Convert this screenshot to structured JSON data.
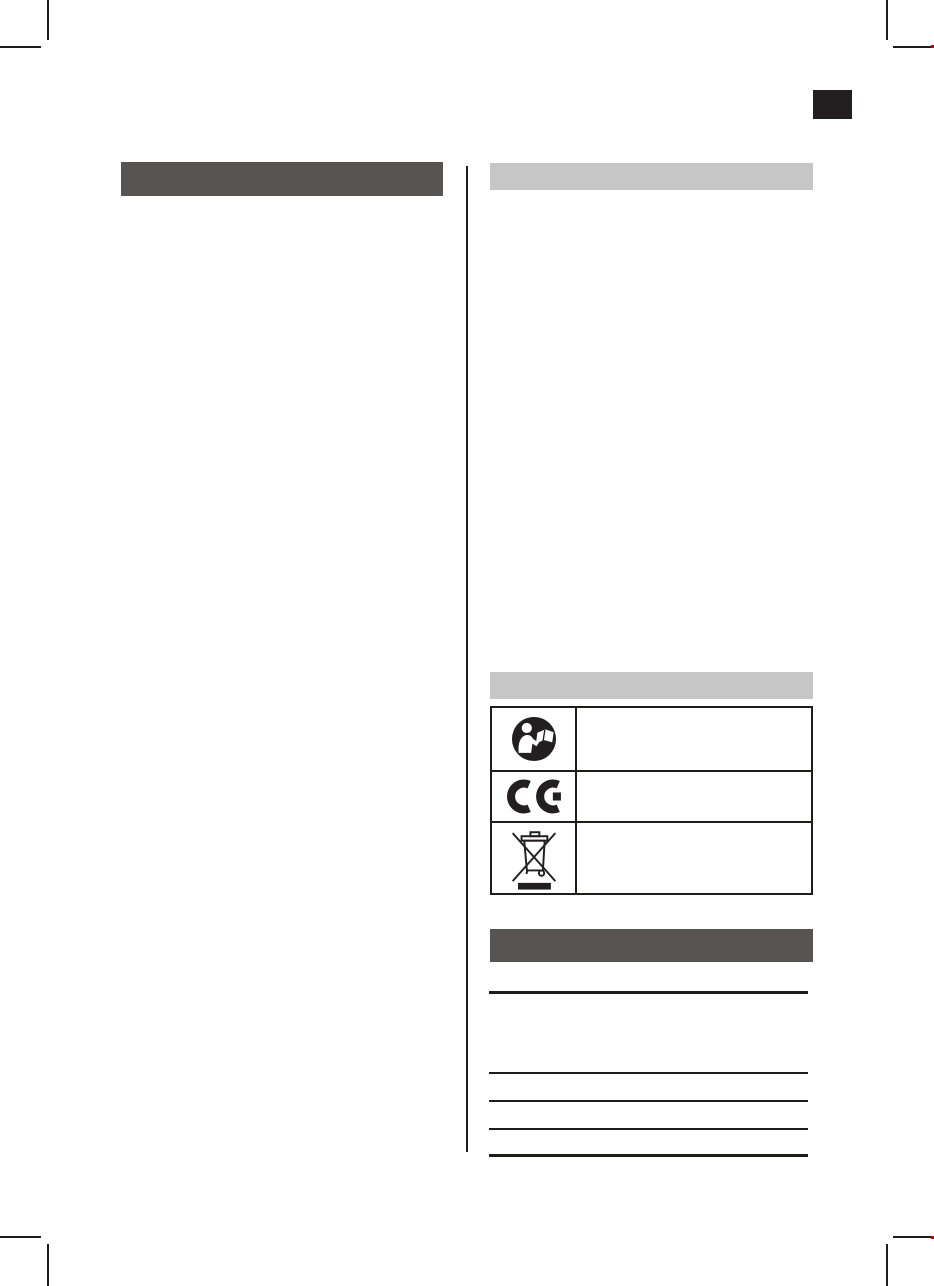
{
  "page": {
    "kind": "printed instruction-manual page (blank text template)",
    "width_px": 934,
    "height_px": 1286,
    "background": "#ffffff"
  },
  "colors": {
    "heading_bar_dark": "#575452",
    "section_bar_light": "#c6c6c6",
    "print_black": "#231f20",
    "rule_line": "#1d1d1b"
  },
  "language_tab": {
    "text": ""
  },
  "left_column": {
    "heading_bar_text": ""
  },
  "right_column": {
    "top_section_bar_text": "",
    "symbols": {
      "section_bar_text": "",
      "rows": [
        {
          "icon": "read-manual-icon",
          "text": ""
        },
        {
          "icon": "ce-mark-icon",
          "text": ""
        },
        {
          "icon": "weee-crossed-out-bin-icon",
          "text": ""
        }
      ]
    },
    "technical_data": {
      "heading_bar_text": "",
      "rows": [
        {
          "text": ""
        },
        {
          "text": ""
        },
        {
          "text": ""
        },
        {
          "text": ""
        }
      ]
    }
  },
  "crop_marks": {
    "positions": [
      "top-left",
      "top-right",
      "bottom-left",
      "bottom-right"
    ]
  }
}
